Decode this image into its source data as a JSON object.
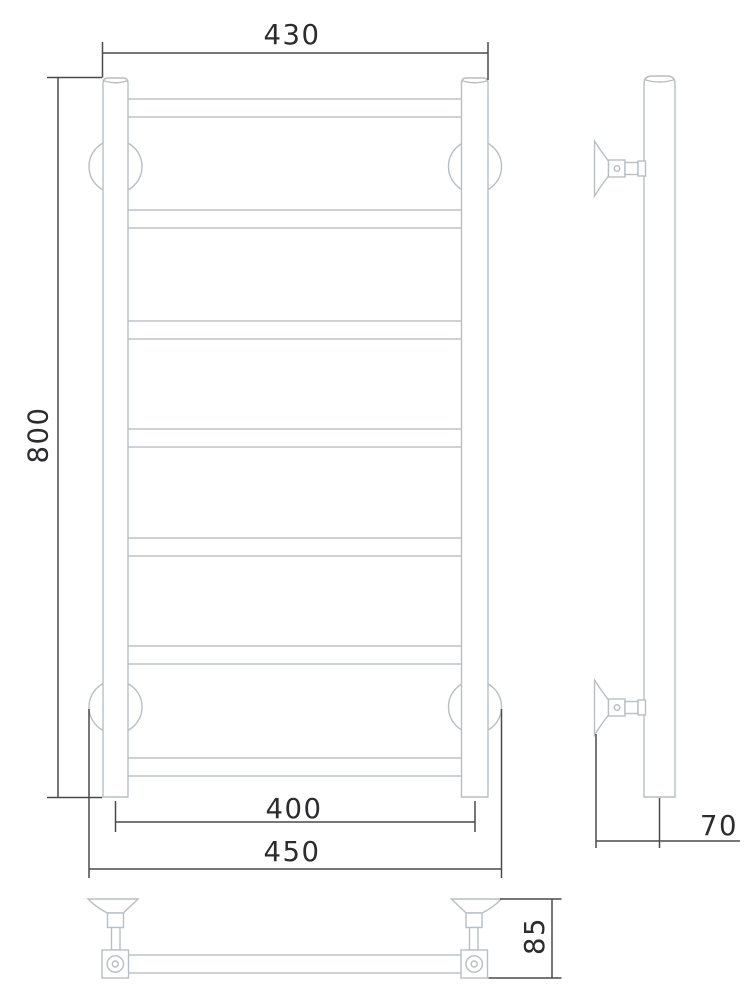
{
  "drawing": {
    "type": "technical-drawing-towel-rail",
    "dimensions": {
      "overall_width": "430",
      "overall_height": "800",
      "pipe_center_width": "400",
      "bracket_width": "450",
      "wall_offset": "70",
      "bracket_depth": "85"
    },
    "structure": {
      "rail_rungs": 7,
      "wall_brackets": 4,
      "views": [
        "front",
        "side",
        "bottom"
      ]
    },
    "colors": {
      "background": "#ffffff",
      "product_outline": "#b7bec4",
      "dimension_line": "#4a4a4d",
      "dimension_text": "#2c2c2e"
    }
  }
}
